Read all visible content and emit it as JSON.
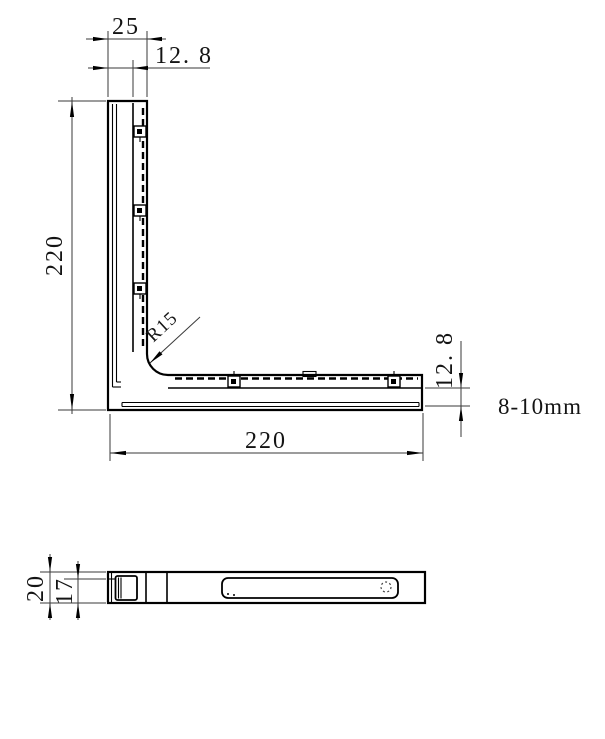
{
  "colors": {
    "background": "#ffffff",
    "line": "#000000",
    "dimension_line": "#3a3a3a",
    "text": "#141414"
  },
  "front_view": {
    "dim_arm_width_top": "25",
    "dim_channel_top": "12. 8",
    "dim_height_left": "220",
    "dim_length_bottom": "220",
    "dim_channel_right": "12. 8",
    "radius_label": "R15",
    "glass_thickness_note": "8-10mm"
  },
  "side_view": {
    "dim_overall_height": "20",
    "dim_inner_height": "17"
  }
}
